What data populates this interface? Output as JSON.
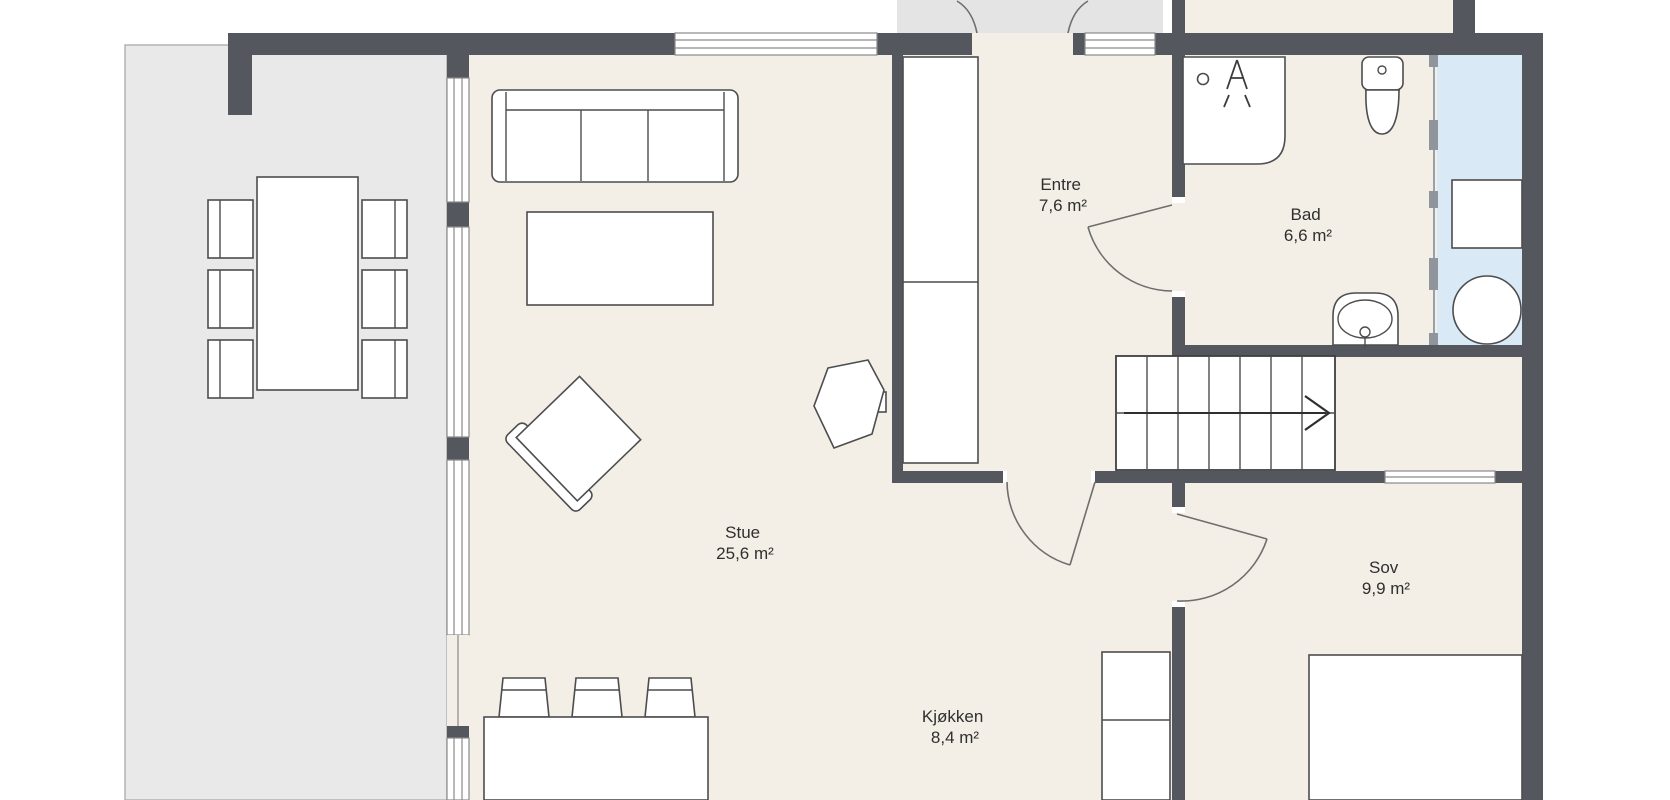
{
  "title": "Floor plan",
  "rooms": [
    {
      "id": "stue",
      "name": "Stue",
      "area": "25,6 m²"
    },
    {
      "id": "kjokken",
      "name": "Kjøkken",
      "area": "8,4 m²"
    },
    {
      "id": "entre",
      "name": "Entre",
      "area": "7,6 m²"
    },
    {
      "id": "bad",
      "name": "Bad",
      "area": "6,6 m²"
    },
    {
      "id": "sov",
      "name": "Sov",
      "area": "9,9 m²"
    }
  ],
  "colors": {
    "wall": "#54585e",
    "floor": "#f4efe6",
    "terrace": "#e9e9e9",
    "porch": "#e4e4e4",
    "wet_area": "#d9eaf6",
    "furniture_outline": "#4d4d4d",
    "label_text": "#2f2f2f"
  },
  "furniture": {
    "stue": [
      "sofa",
      "coffee-table",
      "armchair",
      "side-table"
    ],
    "terrace": [
      "dining-table",
      "dining-chairs-x6"
    ],
    "kjokken": [
      "kitchen-island",
      "bar-stools-x3",
      "kitchen-cabinet"
    ],
    "entre": [
      "wardrobe",
      "stairs"
    ],
    "bad": [
      "shower",
      "toilet",
      "sink",
      "glass-partition",
      "bench",
      "water-heater"
    ],
    "sov": [
      "bed"
    ]
  }
}
